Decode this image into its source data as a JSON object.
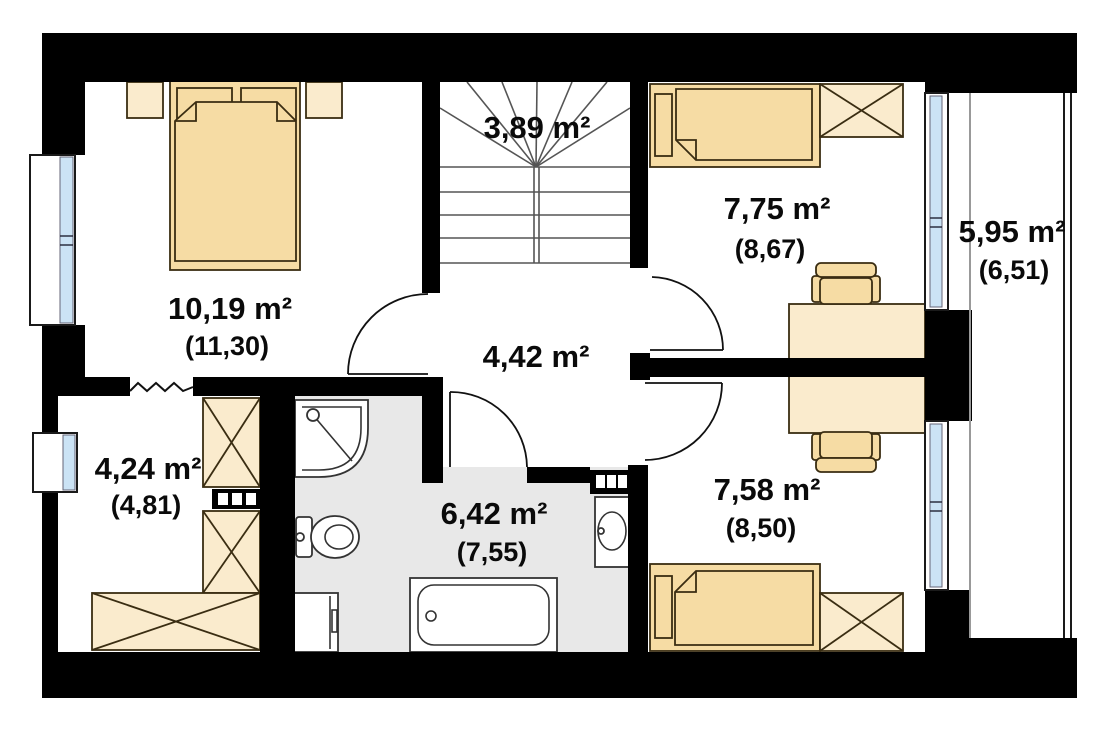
{
  "rooms": {
    "stairs": {
      "area": "3,89 m²"
    },
    "bedroom": {
      "area": "10,19 m²",
      "area_alt": "(11,30)"
    },
    "room_top_right": {
      "area": "7,75 m²",
      "area_alt": "(8,67)"
    },
    "balcony": {
      "area": "5,95 m²",
      "area_alt": "(6,51)"
    },
    "hallway": {
      "area": "4,42 m²"
    },
    "wardrobe_room": {
      "area": "4,24 m²",
      "area_alt": "(4,81)"
    },
    "bathroom": {
      "area": "6,42 m²",
      "area_alt": "(7,55)"
    },
    "room_bottom_right": {
      "area": "7,58 m²",
      "area_alt": "(8,50)"
    }
  },
  "colors": {
    "wall": "#000000",
    "furniture_tan": "#F6DCA4",
    "furniture_cream": "#FAEBCD",
    "bathroom_floor": "#E8E8E8",
    "window_glass": "#CBE3F5",
    "furniture_outline": "#3A2D12"
  }
}
